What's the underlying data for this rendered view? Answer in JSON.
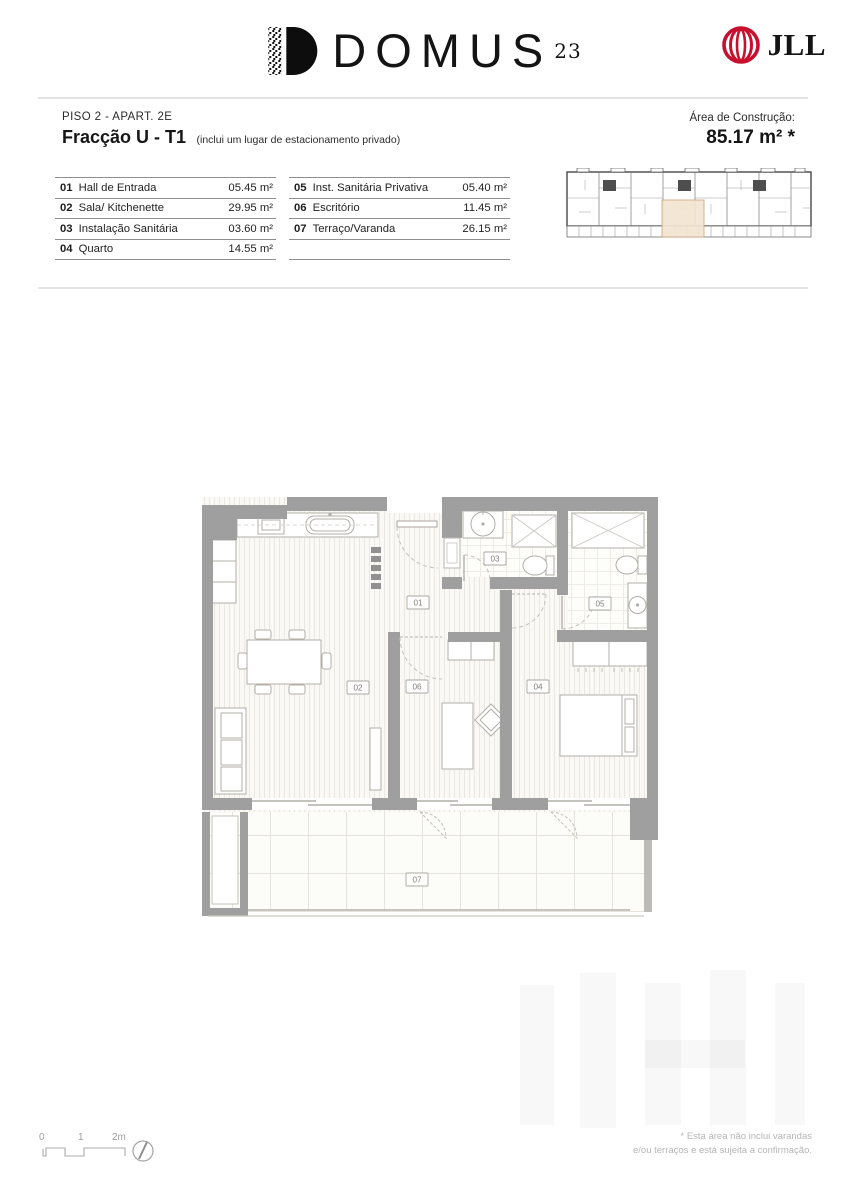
{
  "header": {
    "brand": "DOMUS",
    "brand_sup": "23",
    "partner": "JLL"
  },
  "title": {
    "floor_line": "PISO 2 - APART. 2E",
    "fraction": "Fracção U - T1",
    "fraction_note": "(inclui um lugar de estacionamento privado)"
  },
  "area": {
    "label": "Área de Construção:",
    "value": "85.17 m² *"
  },
  "rooms": [
    {
      "num": "01",
      "name": "Hall de Entrada",
      "area": "05.45 m²"
    },
    {
      "num": "02",
      "name": "Sala/ Kitchenette",
      "area": "29.95 m²"
    },
    {
      "num": "03",
      "name": "Instalação Sanitária",
      "area": "03.60 m²"
    },
    {
      "num": "04",
      "name": "Quarto",
      "area": "14.55 m²"
    },
    {
      "num": "05",
      "name": "Inst. Sanitária Privativa",
      "area": "05.40 m²"
    },
    {
      "num": "06",
      "name": "Escritório",
      "area": "11.45 m²"
    },
    {
      "num": "07",
      "name": "Terraço/Varanda",
      "area": "26.15 m²"
    }
  ],
  "scalebar": {
    "t0": "0",
    "t1": "1",
    "t2": "2m"
  },
  "footer": {
    "line1": "* Esta área não inclui varandas",
    "line2": "e/ou terraços e está sujeita a confirmação."
  },
  "icons": {
    "brand_mark": "domus-d-qr-icon",
    "partner_mark": "jll-globe-icon",
    "compass": "compass-icon"
  },
  "colors": {
    "accent_red": "#c8102e",
    "wall_gray": "#9f9f9f",
    "highlight_beige": "#f3e4d1"
  }
}
